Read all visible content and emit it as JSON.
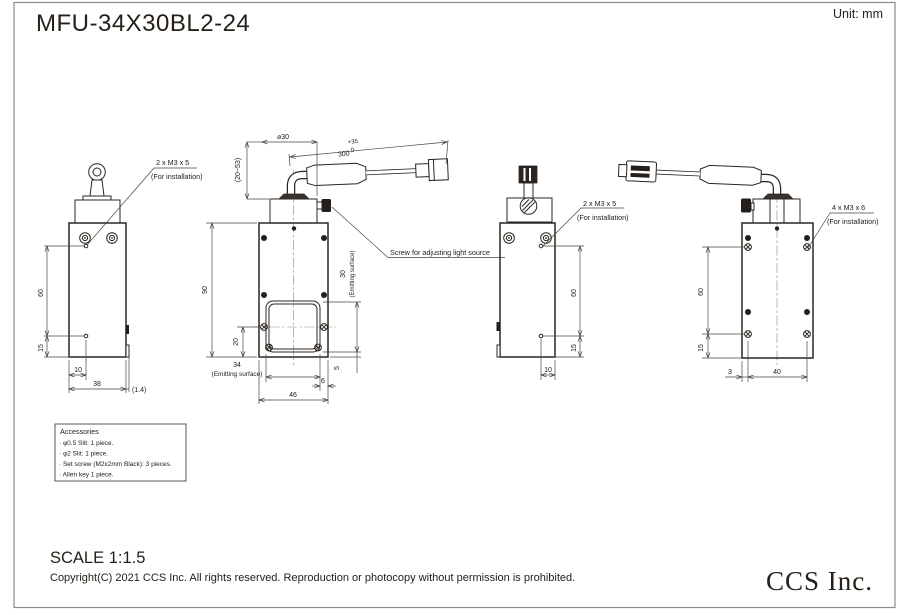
{
  "header": {
    "title": "MFU-34X30BL2-24",
    "unit": "Unit: mm"
  },
  "labels": {
    "install_m3x5": "2 x M3 x 5",
    "install_m3x6": "4 x M3 x 6",
    "for_installation": "(For installation)",
    "adjust_screw": "Screw for adjusting light source",
    "emitting_surface": "(Emitting surface)"
  },
  "dims": {
    "front": {
      "h60": "60",
      "h15": "15",
      "w10": "10",
      "w38": "38",
      "w14": "(1.4)"
    },
    "side": {
      "dia": "⌀30",
      "len300": "300",
      "tol_plus": "+35",
      "tol_zero": "0",
      "range": "(20~53)",
      "h90": "90",
      "h20": "20",
      "w34": "34",
      "w6": "6",
      "w46": "46",
      "h5": "5",
      "h30": "30"
    },
    "rear": {
      "h60": "60",
      "h15": "15",
      "w10": "10"
    },
    "back": {
      "h60": "60",
      "h15": "15",
      "w3": "3",
      "w40": "40"
    }
  },
  "accessories": {
    "title": "Accessories",
    "items": [
      "· φ0.5 Slit:  1 piece.",
      "· φ2 Slit:    1 piece.",
      "· Set screw (M2x2mm Black): 3 pieces.",
      "· Allen key 1 piece."
    ]
  },
  "footer": {
    "scale": "SCALE 1:1.5",
    "copyright": "Copyright(C) 2021 CCS Inc. All rights reserved. Reproduction or photocopy without permission is prohibited.",
    "logo": "CCS Inc."
  }
}
